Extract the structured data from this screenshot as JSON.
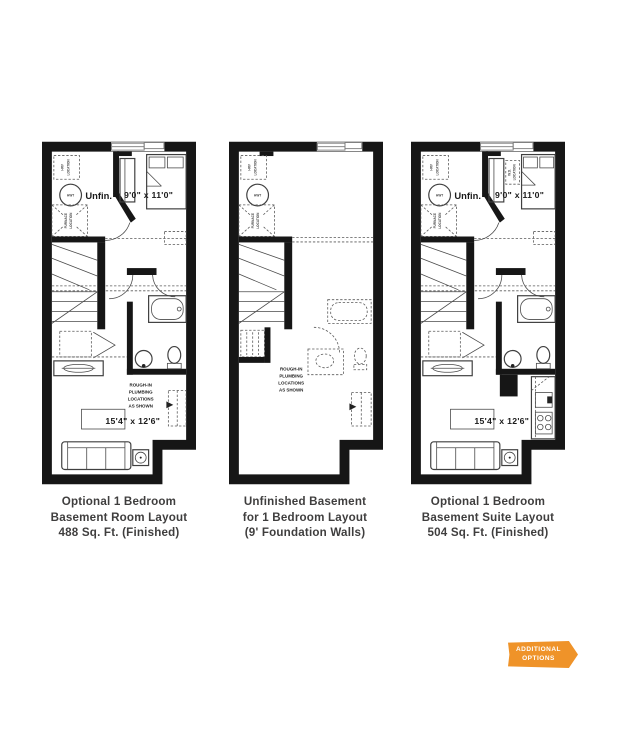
{
  "colors": {
    "wall": "#161616",
    "line": "#3f3f3f",
    "dashed": "#5a5a5a",
    "caption_text": "#3f3e3e",
    "badge_bg": "#EF9329",
    "badge_text": "#ffffff"
  },
  "plans": [
    {
      "caption": [
        "Optional 1 Bedroom",
        "Basement Room Layout",
        "488 Sq. Ft. (Finished)"
      ],
      "labels": {
        "unfinished": "Unfin.",
        "bedroom_dims": "9'0\" x 11'0\"",
        "living_dims": "15'4\" x 12'6\"",
        "hwt": "HWT",
        "hrv_1": "HRV",
        "hrv_2": "LOCATION",
        "furnace_1": "FURNACE",
        "furnace_2": "LOCATION",
        "rough_in": [
          "ROUGH-IN",
          "PLUMBING",
          "LOCATIONS",
          "AS SHOWN"
        ]
      }
    },
    {
      "caption": [
        "Unfinished Basement",
        "for 1 Bedroom Layout",
        "(9' Foundation Walls)"
      ],
      "labels": {
        "hwt": "HWT",
        "hrv_1": "HRV",
        "hrv_2": "LOCATION",
        "furnace_1": "FURNACE",
        "furnace_2": "LOCATION",
        "rough_in": [
          "ROUGH-IN",
          "PLUMBING",
          "LOCATIONS",
          "AS SHOWN"
        ]
      }
    },
    {
      "caption": [
        "Optional 1 Bedroom",
        "Basement Suite Layout",
        "504 Sq. Ft. (Finished)"
      ],
      "labels": {
        "unfinished": "Unfin.",
        "bedroom_dims": "9'0\" x 11'0\"",
        "living_dims": "15'4\" x 12'6\"",
        "hwt": "HWT",
        "hrv_1": "HRV",
        "hrv_2": "LOCATION",
        "furnace_1": "FURNACE",
        "furnace_2": "LOCATION",
        "wd_1": "W.D.",
        "wd_2": "LOCATION"
      }
    }
  ],
  "badge": {
    "line1": "ADDITIONAL",
    "line2": "OPTIONS"
  }
}
